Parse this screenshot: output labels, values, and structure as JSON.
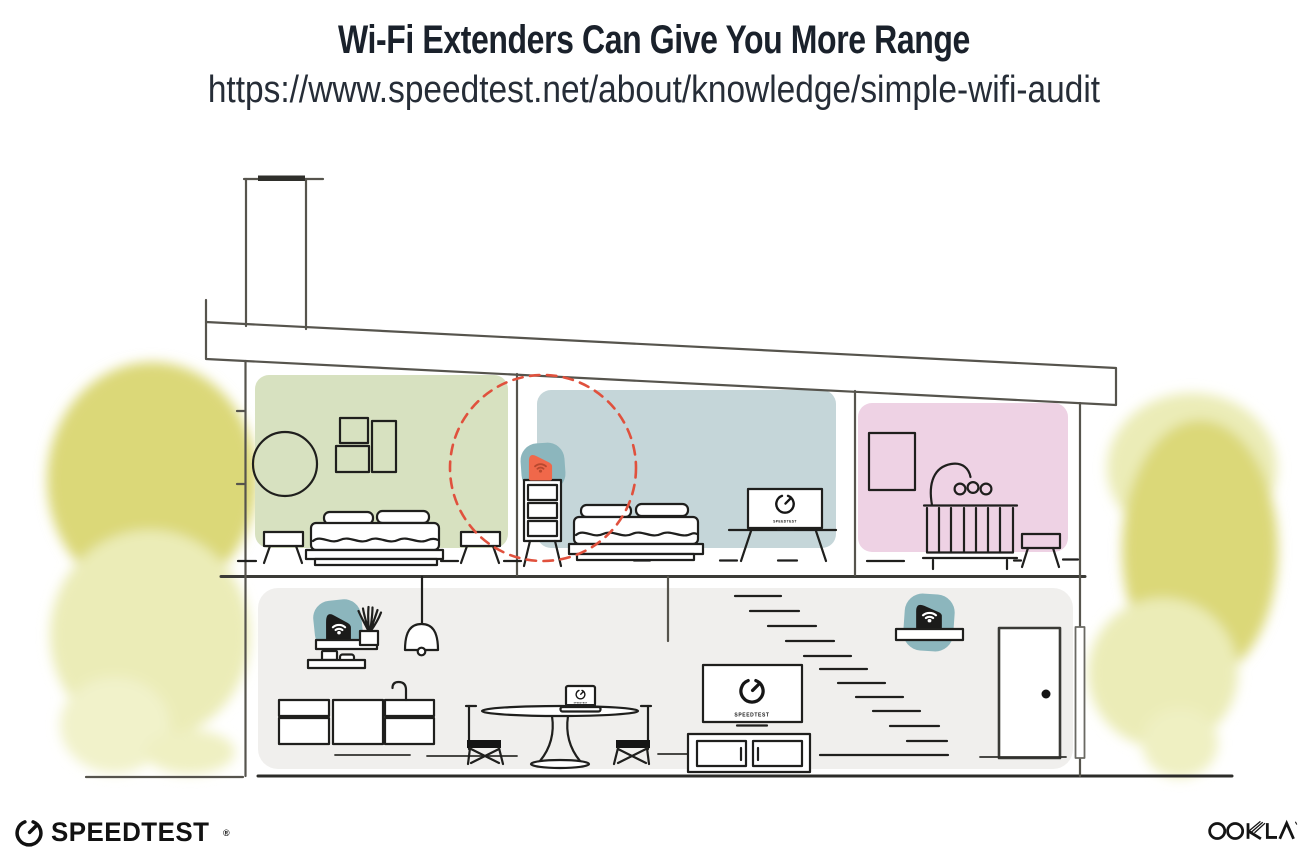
{
  "header": {
    "title": "Wi-Fi Extenders Can Give You More Range",
    "url": "https://www.speedtest.net/about/knowledge/simple-wifi-audit"
  },
  "devices": {
    "screen_label": "SPEEDTEST"
  },
  "footer": {
    "speedtest": "SPEEDTEST",
    "speedtest_reg": "®",
    "ookla": "OOKLA"
  },
  "palette": {
    "room_green": "#d7e1c0",
    "room_blue": "#c5d6d9",
    "room_pink": "#eed2e4",
    "downstairs_gray": "#f0efed",
    "extender_orange": "#f0684a",
    "extender_wifi_orange": "#b8492f",
    "router_black": "#1b1b1a",
    "signal_teal": "#8cb6bd",
    "range_circle_red": "#e0513d",
    "foliage_yellow": "#dbd878",
    "foliage_yellow_light": "#ebecb7",
    "structure_gray": "#56544d",
    "ink": "#1f1f1d"
  }
}
